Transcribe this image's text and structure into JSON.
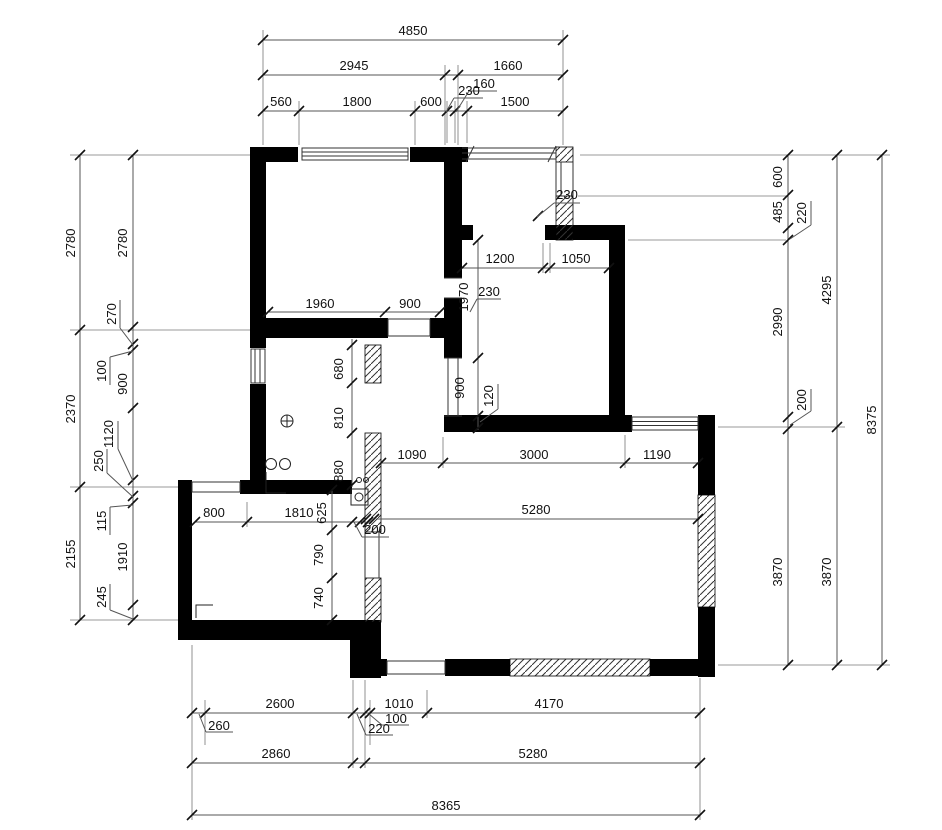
{
  "dims": {
    "top": {
      "d4850": "4850",
      "d2945": "2945",
      "d1660": "1660",
      "d560": "560",
      "d1800": "1800",
      "d600": "600",
      "d1500": "1500",
      "d230": "230",
      "d160": "160"
    },
    "left": {
      "outer2780": "2780",
      "outer2370": "2370",
      "outer2155": "2155",
      "inner2780": "2780",
      "inner270": "270",
      "inner100": "100",
      "inner900": "900",
      "inner1120": "1120",
      "inner250": "250",
      "inner115": "115",
      "inner1910": "1910",
      "inner245": "245"
    },
    "right": {
      "d600": "600",
      "d485": "485",
      "d220": "220",
      "d2990": "2990",
      "d200": "200",
      "d3870a": "3870",
      "d4295": "4295",
      "d3870b": "3870",
      "d8375": "8375"
    },
    "bottom": {
      "d260": "260",
      "d2600": "2600",
      "d220": "220",
      "d100": "100",
      "d1010": "1010",
      "d4170": "4170",
      "d2860": "2860",
      "d5280": "5280",
      "d8365": "8365"
    },
    "interior": {
      "d1960": "1960",
      "d900a": "900",
      "d1200": "1200",
      "d1050": "1050",
      "d230bed": "230",
      "d1970": "1970",
      "d900b": "900",
      "d120": "120",
      "d230balc": "230",
      "d1090": "1090",
      "d3000": "3000",
      "d1190": "1190",
      "d5280": "5280",
      "d200": "200",
      "d800": "800",
      "d1810": "1810",
      "d680": "680",
      "d810": "810",
      "d880": "880",
      "d625": "625",
      "d790": "790",
      "d740": "740"
    }
  }
}
